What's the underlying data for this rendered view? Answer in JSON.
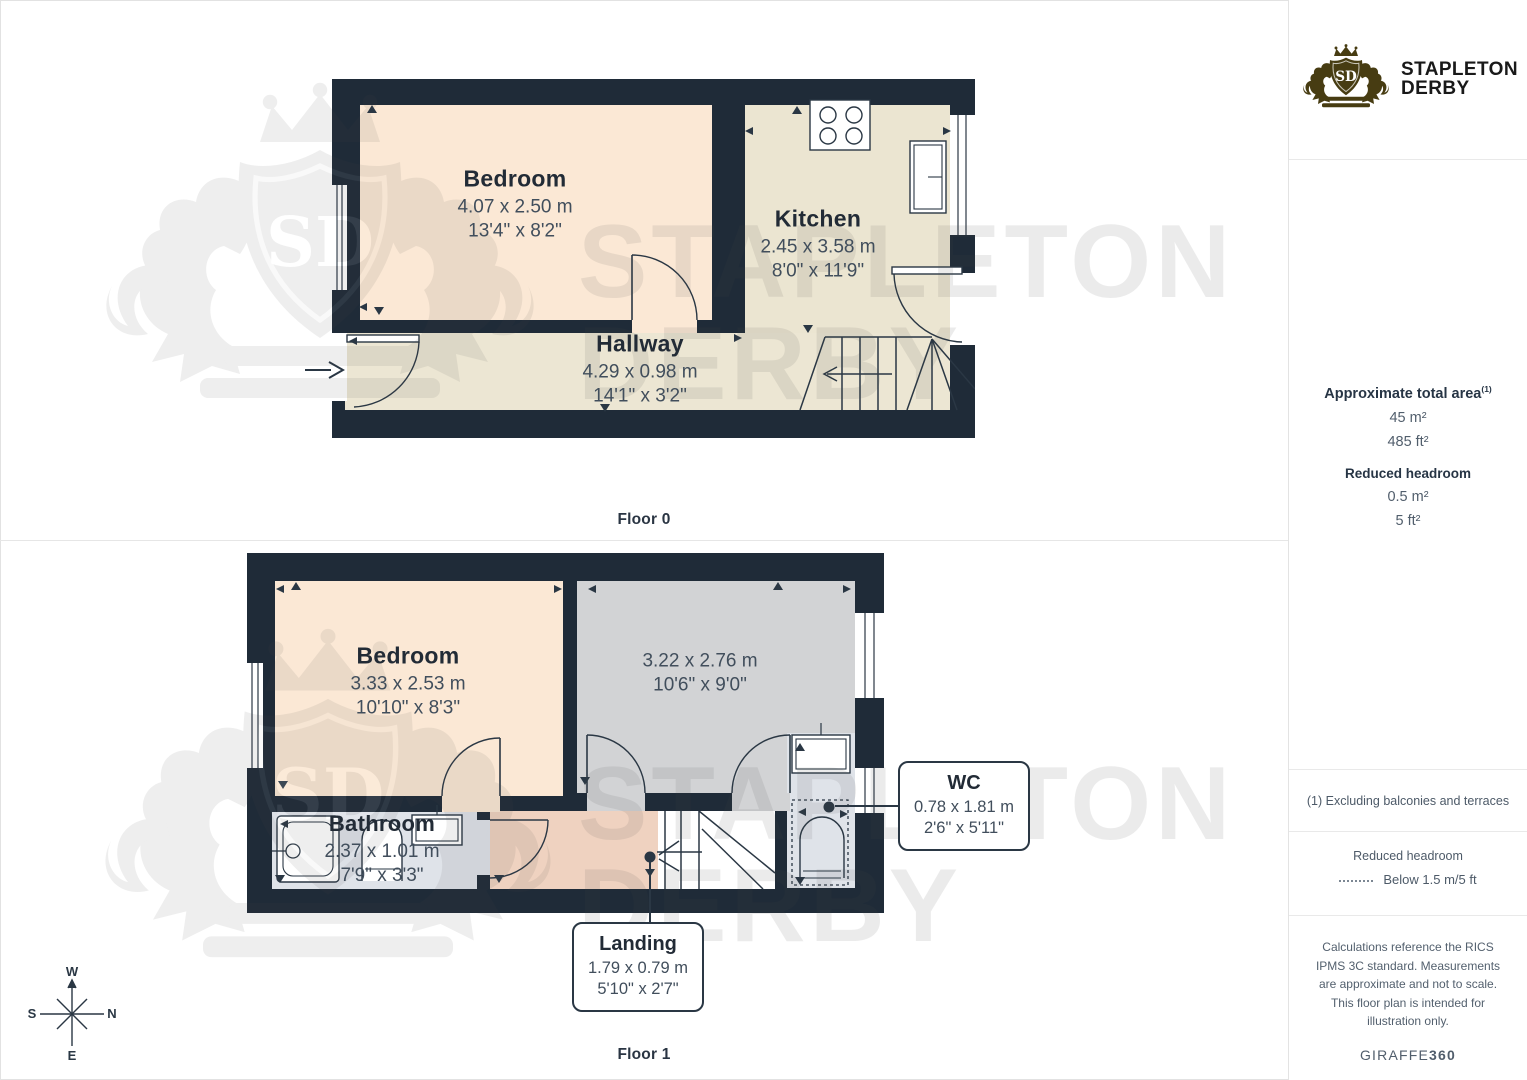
{
  "page": {
    "floor0_label": "Floor 0",
    "floor1_label": "Floor 1"
  },
  "brand": {
    "monogram": "SD",
    "line1": "STAPLETON",
    "line2": "DERBY"
  },
  "sidebar": {
    "area_title": "Approximate total area",
    "area_footnote_marker": "(1)",
    "area_m": "45 m²",
    "area_ft": "485 ft²",
    "reduced_title": "Reduced headroom",
    "reduced_m": "0.5 m²",
    "reduced_ft": "5 ft²",
    "footnote": "(1) Excluding balconies and terraces",
    "legend_title": "Reduced headroom",
    "legend_item": "Below 1.5 m/5 ft",
    "disclaimer": "Calculations reference the RICS IPMS 3C standard. Measurements are approximate and not to scale. This floor plan is intended for illustration only.",
    "credit_regular": "GIRAFFE",
    "credit_bold": "360"
  },
  "floor0": {
    "rooms": [
      {
        "name": "Bedroom",
        "metric": "4.07 x 2.50 m",
        "imperial": "13'4\" x 8'2\""
      },
      {
        "name": "Kitchen",
        "metric": "2.45 x 3.58 m",
        "imperial": "8'0\" x 11'9\""
      },
      {
        "name": "Hallway",
        "metric": "4.29 x 0.98 m",
        "imperial": "14'1\" x 3'2\""
      }
    ]
  },
  "floor1": {
    "rooms": [
      {
        "name": "Bedroom",
        "metric": "3.33 x 2.53 m",
        "imperial": "10'10\" x 8'3\""
      },
      {
        "name": "",
        "metric": "3.22 x 2.76 m",
        "imperial": "10'6\" x 9'0\""
      },
      {
        "name": "Bathroom",
        "metric": "2.37 x 1.01 m",
        "imperial": "7'9\" x 3'3\""
      }
    ],
    "callouts": [
      {
        "name": "WC",
        "metric": "0.78 x 1.81 m",
        "imperial": "2'6\" x 5'11\""
      },
      {
        "name": "Landing",
        "metric": "1.79 x 0.79 m",
        "imperial": "5'10\" x 2'7\""
      }
    ]
  },
  "compass": {
    "top": "W",
    "left": "S",
    "right": "N",
    "bottom": "E"
  },
  "watermark": {
    "line1": "STAPLETON",
    "line2": "DERBY"
  },
  "colors": {
    "wall": "#1f2b38",
    "bedroom": "#fbe8d5",
    "kitchen": "#ebe5d1",
    "hallway": "#ece6d3",
    "room_gray": "#d2d3d5",
    "bathroom": "#dfe3e9",
    "landing": "#efd2c0",
    "line": "#2a3744",
    "brand_gold": "#473c12",
    "text_dark": "#222b36",
    "text_dim": "#414e5c"
  }
}
